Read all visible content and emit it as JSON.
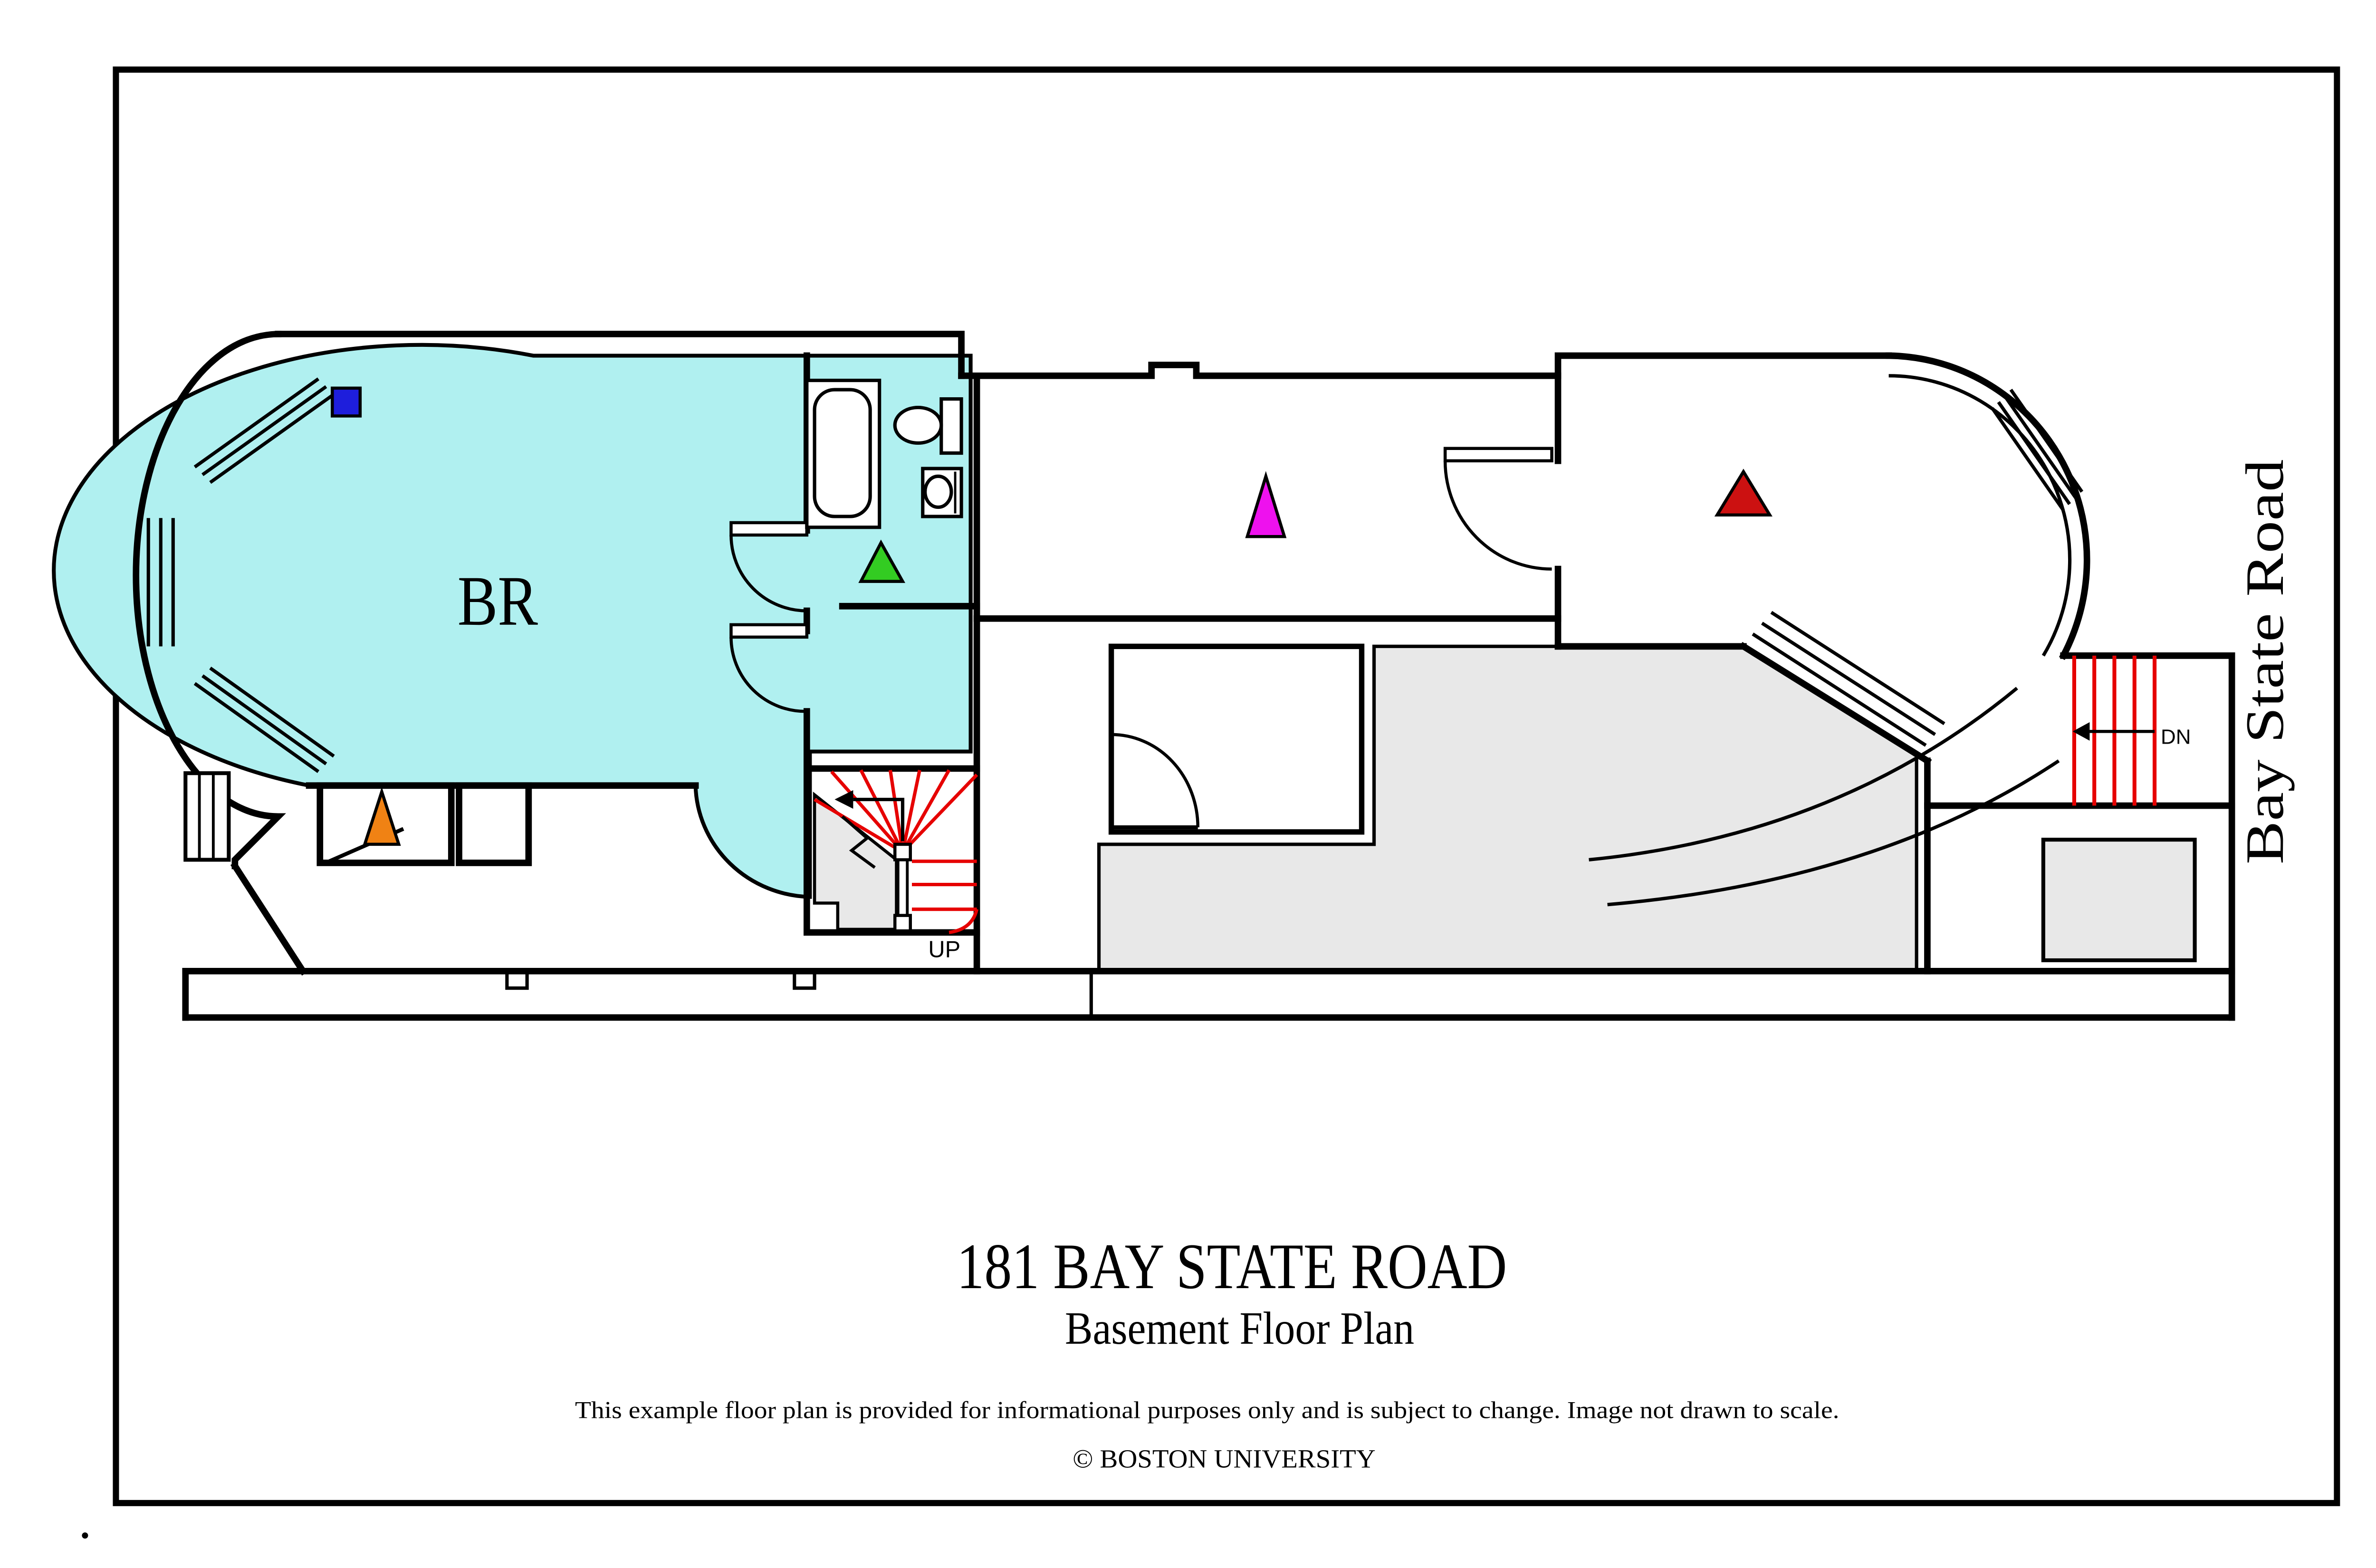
{
  "document": {
    "title": "181 BAY STATE ROAD",
    "subtitle": "Basement Floor Plan",
    "disclaimer": "This example floor plan is provided for informational purposes only and is subject to change. Image not drawn to scale.",
    "copyright": "© BOSTON UNIVERSITY"
  },
  "street": {
    "name": "Bay State Road"
  },
  "labels": {
    "bedroom": "BR",
    "stairs_up": "UP",
    "stairs_down": "DN"
  },
  "colors": {
    "page_background": "#FFFFFF",
    "wall_line": "#000000",
    "bedroom_unit_fill": "#B0F0F0",
    "unexcavated_fill": "#E8E8E8",
    "stair_tread_red": "#E60000"
  },
  "markers": {
    "blue_square": {
      "shape": "square",
      "color": "#1E1EDC",
      "location": "bedroom north-west corner"
    },
    "orange_triangle": {
      "shape": "triangle",
      "color": "#F08214",
      "location": "closet below bedroom"
    },
    "green_triangle": {
      "shape": "triangle",
      "color": "#33CC22",
      "location": "bathroom"
    },
    "magenta_triangle": {
      "shape": "triangle",
      "color": "#EE11EE",
      "location": "center room"
    },
    "red_triangle": {
      "shape": "triangle",
      "color": "#CC1111",
      "location": "east room"
    }
  }
}
